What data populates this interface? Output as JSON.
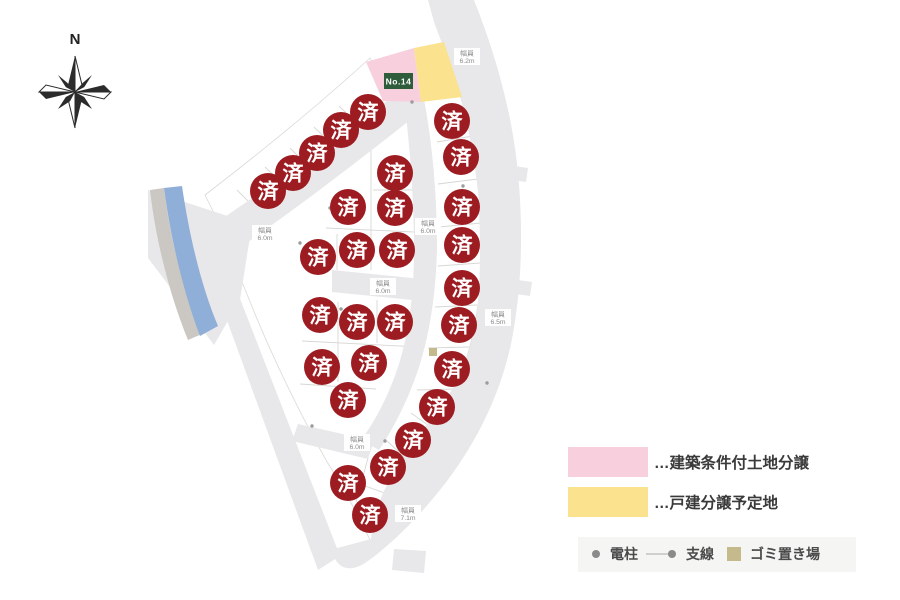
{
  "compass": {
    "north_label": "N"
  },
  "map": {
    "sold_label": "済",
    "lot_number_label": "No.14",
    "road_width_caption": "幅員",
    "road_labels": [
      {
        "x": 467,
        "y": 57,
        "value": "6.2m"
      },
      {
        "x": 265,
        "y": 234,
        "value": "6.0m"
      },
      {
        "x": 428,
        "y": 227,
        "value": "6.0m"
      },
      {
        "x": 383,
        "y": 287,
        "value": "6.0m"
      },
      {
        "x": 498,
        "y": 318,
        "value": "6.5m"
      },
      {
        "x": 357,
        "y": 443,
        "value": "6.0m"
      },
      {
        "x": 408,
        "y": 514,
        "value": "7.1m"
      }
    ],
    "sold_markers": [
      {
        "x": 268,
        "y": 191
      },
      {
        "x": 293,
        "y": 173
      },
      {
        "x": 317,
        "y": 153
      },
      {
        "x": 341,
        "y": 130
      },
      {
        "x": 368,
        "y": 112
      },
      {
        "x": 452,
        "y": 121
      },
      {
        "x": 461,
        "y": 157
      },
      {
        "x": 462,
        "y": 207
      },
      {
        "x": 462,
        "y": 245
      },
      {
        "x": 462,
        "y": 288
      },
      {
        "x": 459,
        "y": 325
      },
      {
        "x": 452,
        "y": 369
      },
      {
        "x": 437,
        "y": 407
      },
      {
        "x": 413,
        "y": 440
      },
      {
        "x": 388,
        "y": 467
      },
      {
        "x": 348,
        "y": 483
      },
      {
        "x": 370,
        "y": 515
      },
      {
        "x": 395,
        "y": 173
      },
      {
        "x": 348,
        "y": 207
      },
      {
        "x": 395,
        "y": 208
      },
      {
        "x": 318,
        "y": 257
      },
      {
        "x": 357,
        "y": 250
      },
      {
        "x": 397,
        "y": 250
      },
      {
        "x": 320,
        "y": 315
      },
      {
        "x": 357,
        "y": 322
      },
      {
        "x": 395,
        "y": 322
      },
      {
        "x": 322,
        "y": 367
      },
      {
        "x": 369,
        "y": 363
      },
      {
        "x": 348,
        "y": 400
      }
    ],
    "poles": [
      {
        "x": 412,
        "y": 102
      },
      {
        "x": 330,
        "y": 208
      },
      {
        "x": 463,
        "y": 186
      },
      {
        "x": 300,
        "y": 243
      },
      {
        "x": 341,
        "y": 309
      },
      {
        "x": 312,
        "y": 426
      },
      {
        "x": 385,
        "y": 441
      },
      {
        "x": 487,
        "y": 383
      }
    ],
    "garbage_spots": [
      {
        "x": 429,
        "y": 348
      }
    ]
  },
  "legend": {
    "items": [
      {
        "swatch": "pink",
        "label": "…建築条件付土地分譲"
      },
      {
        "swatch": "yellow",
        "label": "…戸建分譲予定地"
      }
    ],
    "symbols": [
      {
        "icon": "pole-dot",
        "label": "電柱"
      },
      {
        "icon": "line-dot",
        "label": "支線"
      },
      {
        "icon": "square",
        "label": "ゴミ置き場"
      }
    ]
  },
  "colors": {
    "road": "#e8e8ea",
    "lot_fill": "#ffffff",
    "lot_stroke": "#d9d9d7",
    "sold_bg": "#9d1c21",
    "sold_text": "#ffffff",
    "pink": "#f8cfdd",
    "yellow": "#fae28e",
    "green": "#2f5d3c",
    "blue": "#8fafd8",
    "beige": "#cbc8c3",
    "khaki": "#c5ba8c",
    "pole": "#9c9c9c",
    "road_label_text": "#8b8b8b",
    "legend_text": "#3a3a3a",
    "legend_box_bg": "#f5f5f3"
  }
}
